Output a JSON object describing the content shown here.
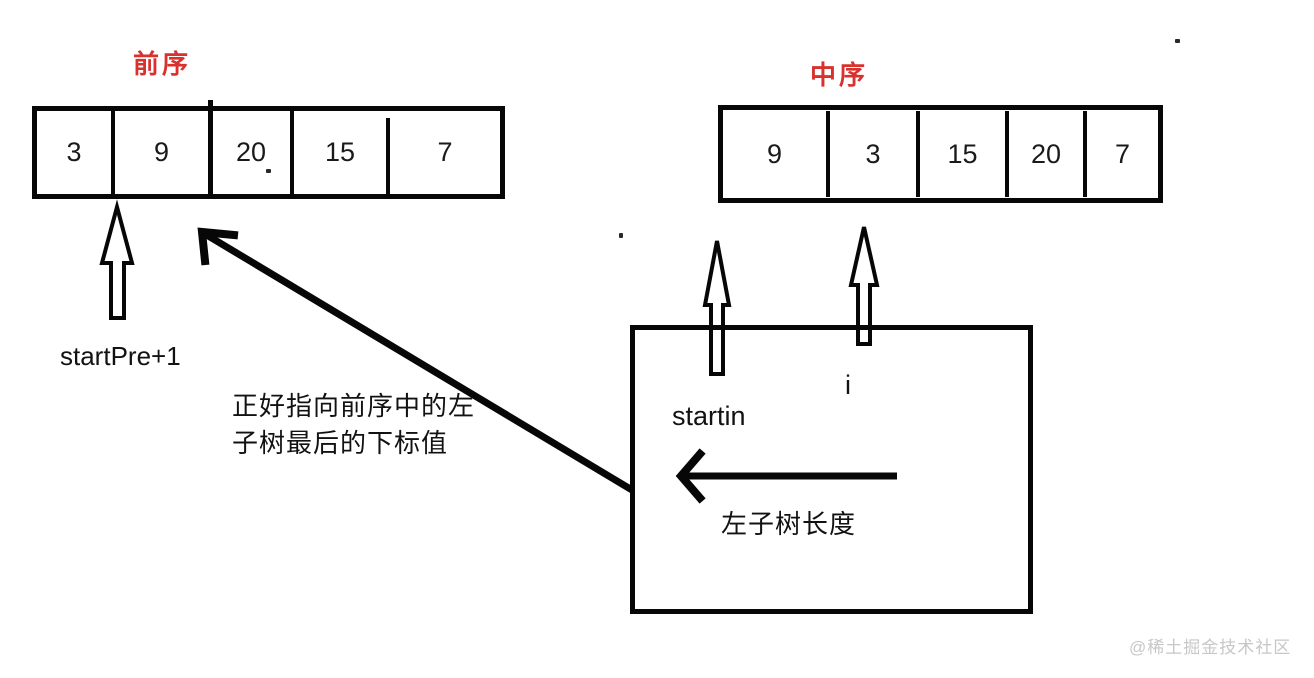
{
  "diagram": {
    "preorder": {
      "label": "前序",
      "cells": [
        "3",
        "9",
        "20",
        "15",
        "7"
      ]
    },
    "inorder": {
      "label": "中序",
      "cells": [
        "9",
        "3",
        "15",
        "20",
        "7"
      ]
    },
    "labels": {
      "startPre": "startPre+1",
      "noteLine1": "正好指向前序中的左",
      "noteLine2": "子树最后的下标值",
      "startIn": "startin",
      "i": "i",
      "leftSubtreeLength": "左子树长度"
    },
    "icons": {
      "preorderPointer": "up-arrow-icon",
      "startInPointer": "up-arrow-icon",
      "iPointer": "up-arrow-icon",
      "noteArrow": "diagonal-up-left-arrow-icon",
      "lengthArrow": "left-arrow-icon"
    },
    "colors": {
      "labelRed": "#d9312e",
      "ink": "#070707",
      "watermark": "#c7c7c7"
    }
  },
  "watermark": "@稀土掘金技术社区"
}
